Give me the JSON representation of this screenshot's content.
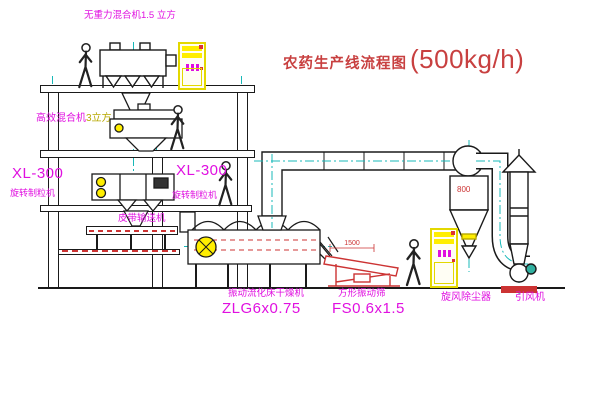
{
  "title": {
    "main": "农药生产线流程图",
    "capacity": "(500kg/h)"
  },
  "labels": {
    "top_mixer": "无重力混合机1.5 立方",
    "mixer_name": "高效混合机",
    "mixer_spec": "3立方",
    "gran_left_model": "XL-300",
    "gran_left_name": "旋转制粒机",
    "gran_right_model": "XL-300",
    "gran_right_name": "旋转制粒机",
    "belt_conveyor": "皮带输送机",
    "dryer_name": "振动流化床干燥机",
    "dryer_model": "ZLG6x0.75",
    "sieve_name": "方形振动筛",
    "sieve_model": "FS0.6x1.5",
    "cyclone_name": "旋风除尘器",
    "fan_name": "引风机"
  },
  "dims": {
    "sieve_length": "1500",
    "cyclone_dia": "800"
  },
  "colors": {
    "label_magenta": "#e010e0",
    "annotation_red": "#cc3333",
    "equipment_yellow": "#ffee00",
    "centerline_teal": "#18b8b8",
    "line_black": "#1a1a1a"
  }
}
